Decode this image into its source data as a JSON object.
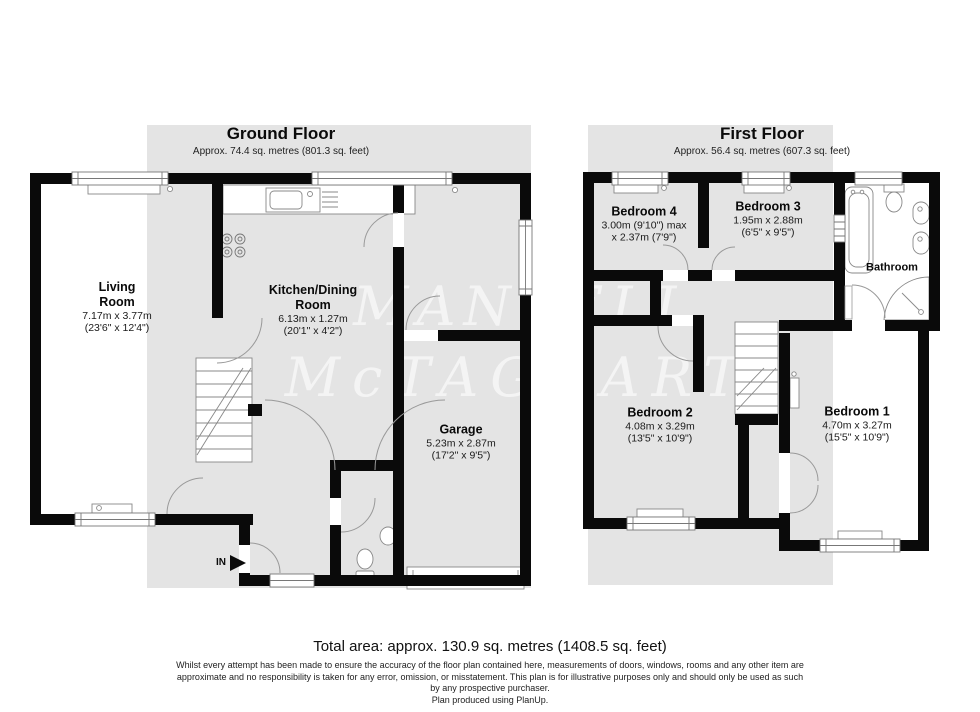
{
  "ground_floor": {
    "title": "Ground Floor",
    "subtitle": "Approx. 74.4 sq. metres (801.3 sq. feet)",
    "rooms": {
      "living_room": {
        "name_line1": "Living",
        "name_line2": "Room",
        "size_metric": "7.17m x 3.77m",
        "size_imperial": "(23'6\" x 12'4\")"
      },
      "kitchen_dining": {
        "name_line1": "Kitchen/Dining",
        "name_line2": "Room",
        "size_metric": "6.13m x 1.27m",
        "size_imperial": "(20'1\" x 4'2\")"
      },
      "garage": {
        "name": "Garage",
        "size_metric": "5.23m x 2.87m",
        "size_imperial": "(17'2\" x 9'5\")"
      }
    },
    "entrance_label": "IN"
  },
  "first_floor": {
    "title": "First Floor",
    "subtitle": "Approx. 56.4 sq. metres (607.3 sq. feet)",
    "rooms": {
      "bedroom_4": {
        "name": "Bedroom 4",
        "size_line1": "3.00m (9'10\") max",
        "size_line2": "x 2.37m (7'9\")"
      },
      "bedroom_3": {
        "name": "Bedroom 3",
        "size_metric": "1.95m x 2.88m",
        "size_imperial": "(6'5\" x 9'5\")"
      },
      "bedroom_2": {
        "name": "Bedroom 2",
        "size_metric": "4.08m x 3.29m",
        "size_imperial": "(13'5\" x 10'9\")"
      },
      "bedroom_1": {
        "name": "Bedroom 1",
        "size_metric": "4.70m x 3.27m",
        "size_imperial": "(15'5\" x 10'9\")"
      },
      "bathroom": {
        "name": "Bathroom"
      }
    }
  },
  "watermark": {
    "line1": "MANSELL",
    "line2": "McTAGGART"
  },
  "footer": {
    "total_area": "Total area: approx. 130.9 sq. metres (1408.5 sq. feet)",
    "disclaimer_line1": "Whilst every attempt has been made to ensure the accuracy of the floor plan contained here, measurements of doors, windows, rooms and any other item are",
    "disclaimer_line2": "approximate and no responsibility is taken for any error, omission, or misstatement. This plan is for illustrative purposes only and should only be used as such",
    "disclaimer_line3": "by any prospective purchaser.",
    "disclaimer_line4": "Plan produced using PlanUp."
  },
  "colors": {
    "wall": "#0a0a0a",
    "panel": "#e4e4e4",
    "fixture_line": "#888888"
  }
}
